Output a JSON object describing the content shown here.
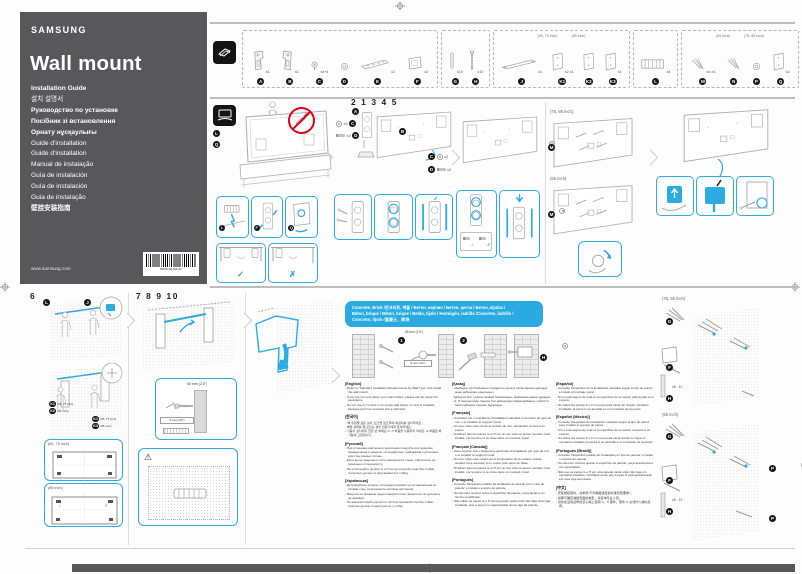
{
  "page": {
    "accent_color": "#2dace3",
    "cover_color": "#58585a",
    "header_color": "#29abe2"
  },
  "cover": {
    "brand": "SAMSUNG",
    "title": "Wall mount",
    "languages": [
      "Installation Guide",
      "설치 설명서",
      "Руководство по установке",
      "Посібник зі встановлення",
      "Орнату нұсқаулығы",
      "Guide d'installation",
      "Guide d'installation",
      "Manual de instalação",
      "Guía de instalación",
      "Guía de instalación",
      "Guia de instalação",
      "壁挂安装指南"
    ],
    "website": "www.samsung.com",
    "part_number": "BN68-11170A-02"
  },
  "letters": {
    "a": "A",
    "b": "B",
    "c": "C",
    "d": "D",
    "e": "E",
    "f": "F",
    "g": "G",
    "h": "H",
    "j": "J",
    "k1": "K1",
    "k2": "K2",
    "k3": "K3",
    "l": "L",
    "m": "M",
    "n": "N",
    "p": "P",
    "q": "Q"
  },
  "sizes": {
    "s6575": "(65, 75 inch)",
    "s85": "(85 inch)",
    "s65": "(65 inch)",
    "s7585": "(75, 85 inch)"
  },
  "steps": {
    "group1": "2 1 3 4 5",
    "six": "6",
    "group2": "7 8 9 10",
    "c1": "1",
    "c2": "2",
    "c3": "3"
  },
  "marks": {
    "ok": "✓",
    "no": "✗",
    "warn": "⚠"
  },
  "labels": {
    "x2": "x2"
  },
  "measure": {
    "depth": "65 mm (2.5\")",
    "drill": "5 mm (1/4\")",
    "range": "x8 - 10"
  },
  "tv_lr": {
    "left": "L",
    "right": "R"
  },
  "parts_strip": {
    "groups": [
      {
        "size_notes": [],
        "items": [
          {
            "id": "A",
            "qty": "x1",
            "icon": "bracket-left"
          },
          {
            "id": "B",
            "qty": "x1",
            "icon": "bracket-right"
          },
          {
            "id": "C",
            "qty": "x4+4",
            "icon": "screw-small"
          },
          {
            "id": "D",
            "qty": "",
            "icon": "washer"
          },
          {
            "id": "E",
            "qty": "x2",
            "icon": "rail-short"
          },
          {
            "id": "F",
            "qty": "x2",
            "icon": "plate-square"
          }
        ]
      },
      {
        "size_notes": [],
        "items": [
          {
            "id": "G",
            "qty": "x10",
            "icon": "anchor"
          },
          {
            "id": "H",
            "qty": "x10",
            "icon": "screw-long"
          }
        ]
      },
      {
        "size_notes": [
          "(65, 75 inch)",
          "(85 inch)"
        ],
        "items": [
          {
            "id": "J",
            "qty": "x1",
            "icon": "bar-long"
          },
          {
            "id": "K1",
            "qty": "x2 x1",
            "icon": "sheet"
          },
          {
            "id": "K2",
            "qty": "",
            "icon": "sheet"
          },
          {
            "id": "K3",
            "qty": "x1",
            "icon": "sheet"
          }
        ]
      },
      {
        "size_notes": [],
        "items": [
          {
            "id": "L",
            "qty": "x4",
            "icon": "spacer-comb"
          }
        ]
      },
      {
        "size_notes": [
          "(65 inch)",
          "(75, 85 inch)"
        ],
        "items": [
          {
            "id": "M",
            "qty": "x4 x4",
            "icon": "screw-pack"
          },
          {
            "id": "N",
            "qty": "",
            "icon": "screw-pack"
          },
          {
            "id": "P",
            "qty": "",
            "icon": "washer"
          },
          {
            "id": "Q",
            "qty": "x2",
            "icon": "sheet"
          }
        ]
      }
    ]
  },
  "wall_header": {
    "lines": [
      "Concrete, Brick /콘크리트, 벽돌 / Бетон, кирпич / Бетон, цегла / Бетон, кірпіш /",
      "Béton, brique / Béton, brique / Betão, tijolo / Hormigón, ladrillo /Concreto, ladrillo /",
      "Concreto, tijolo /混凝土、砖块"
    ]
  },
  "instructions": {
    "columns": [
      [
        {
          "heading": "[English]",
          "bullets": [
            "Refer to \"Standard Installation Requirements by Wall Type\" and install the wall mount.",
            "If you are not sure about your wall surface, please ask an expert for assistance.",
            "Do not use G, H parts in an empty wall where no stud is installed, because part G is screwed into a wall stud."
          ]
        },
        {
          "heading": "[한국어]",
          "bullets": [
            "'벽 유형별 표준 설치 요건'을 참조하여 벽걸이를 설치하세요.",
            "벽면 상태를 잘 모르는 경우 전문가에게 문의하세요.",
            "기둥이 설치되지 않은 빈 벽에는 G, H 부품을 사용하지 마세요. G 부품은 벽 기둥에 고정됩니다."
          ]
        },
        {
          "heading": "[Русский]",
          "bullets": [
            "При установке настенного крепления следуйте инструкциям, приведенным в разделе «Стандартные требования к установке для стен разных типов».",
            "Если вы не уверены в типе поверхности стены, обратитесь за помощью к специалисту.",
            "Не используйте детали G и H на пустотелой стене без стойки, поскольку деталь G вкручивается в стойку."
          ]
        },
        {
          "heading": "[Українська]",
          "bullets": [
            "Дотримуйтесь розділу «Стандартні вимоги до встановлення за типами стін» та встановіть настінне кріплення.",
            "Якщо ви не впевнені щодо поверхні стіни, зверніться по допомогу до фахівця.",
            "Не використовуйте деталі G та H на порожній стіні без стійки, оскільки деталь G вкручується у стійку."
          ]
        }
      ],
      [
        {
          "heading": "[Қазақ]",
          "bullets": [
            "«Қабырға түрі бойынша стандартты орнату талаптарын» қараңыз және қабырғаға орнатыңыз.",
            "Қабырға беті туралы сенімді болмасаңыз, маманнан көмек сұраңыз.",
            "G, H бөлшектерін тіреусіз бос қабырғада пайдаланбаңыз, себебі G бөлігі қабырға тіреуіне бұралады."
          ]
        },
        {
          "heading": "[Français]",
          "bullets": [
            "Consultez les « Conditions d'installation standard en fonction du type de mur » et installez le support mural.",
            "Si vous n'êtes pas sûr de la surface du mur, demandez conseil à un expert.",
            "N'utilisez pas les pièces G et H sur un mur vide où aucun montant n'est installé, car la pièce G se visse dans un montant mural."
          ]
        },
        {
          "heading": "[Français (Canada)]",
          "bullets": [
            "Vous reporter aux « Exigences générales d'installation par type de mur » et installer le support mural.",
            "Si vous n'êtes pas certain de la composition de la surface murale, veuillez vous adresser à un expert pour avoir de l'aide.",
            "N'utilisez pas les pièces G et H sur un mur vide où aucun montant n'est installé, car la pièce G se visse dans un montant mural."
          ]
        },
        {
          "heading": "[Português]",
          "bullets": [
            "Consulte 'Requisitos padrão de instalação de acordo com o tipo de parede' e instale o suporte de parede.",
            "Se não tiver certeza sobre a superfície da parede, peça ajuda a um técnico qualificado.",
            "Não utilize as peças G e H numa parede vazia onde não haja uma viga instalada, pois a peça G é aparafusada numa viga da parede."
          ]
        }
      ],
      [
        {
          "heading": "[Español]",
          "bullets": [
            "Consulte 'Requisitos de la instalación estándar según el tipo de pared' e instale el montaje mural.",
            "Si no está seguro de cuál es la superficie de su pared, pida ayuda a un experto.",
            "No utilice las piezas G y H en una pared vacía sin ningún montante instalado; la pieza G se atornilla en un montante de la pared."
          ]
        },
        {
          "heading": "[Español (México)]",
          "bullets": [
            "Consulte 'Requisitos de instalación estándar según el tipo de pared' para instalar el soporte de pared.",
            "Si no está seguro de cuál es la superficie de su pared, consulte a un experto.",
            "No utilice las piezas G y H en una pared vacía donde no haya un montante instalado; la pieza G se atornilla a un montante de la pared."
          ]
        },
        {
          "heading": "[Português (Brasil)]",
          "bullets": [
            "Consulte 'Requisitos padrão de instalação por tipo de parede' e instale o suporte de parede.",
            "Se não tiver certeza quanto à superfície da parede, peça assistência a um especialista.",
            "Não use as peças G e H em uma parede vazia onde não haja um montante instalado. Certifique-se de que a peça G está aparafusada em uma viga da parede."
          ]
        },
        {
          "heading": "[中文]",
          "bullets": [
            "安装壁挂架时，请参阅\"不同墙壁类型的标准安装要求\"。",
            "如果不确定墙壁表面的类型，请咨询专业人员。",
            "请勿在没有龙骨的空心墙上使用 G、H 部件。部件 G 必须拧入墙内龙骨。"
          ]
        }
      ]
    ]
  }
}
